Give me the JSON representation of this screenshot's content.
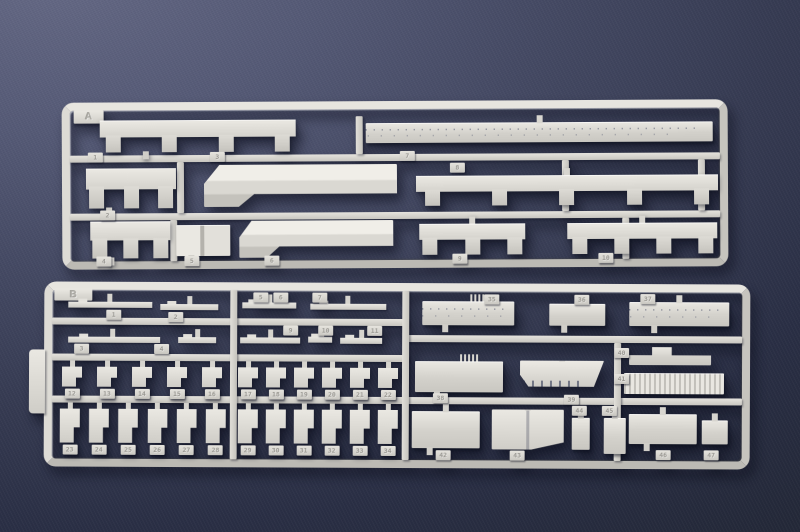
{
  "scene": {
    "subject": "Two injection-molded light-gray plastic model kit sprues (runners A and B) holding warship hull, deck and superstructure parts, photographed on a dark navy blue textured backdrop",
    "plastic_color": "#d8d6d0",
    "background_top_left": "#606482",
    "background_center": "#3d4259",
    "background_corner": "#252a3e"
  },
  "sprue_a": {
    "label": "A",
    "tags": {
      "p1": "1",
      "p2": "2",
      "p3": "3",
      "p4": "4",
      "p5": "5",
      "p6": "6",
      "p7": "7",
      "p8": "8",
      "p9": "9",
      "p10": "10"
    }
  },
  "sprue_b": {
    "label": "B",
    "strip_tags": {
      "l1": "1",
      "l2": "2",
      "l3": "3",
      "l4": "4",
      "m1": "5",
      "m2": "6",
      "m3": "7",
      "m4": "9",
      "m5": "10",
      "m6": "11"
    },
    "row3_left": [
      "12",
      "13",
      "14",
      "15",
      "16"
    ],
    "row3_mid": [
      "17",
      "18",
      "19",
      "20",
      "21",
      "22"
    ],
    "row4_left": [
      "23",
      "24",
      "25",
      "26",
      "27",
      "28"
    ],
    "row4_mid": [
      "29",
      "30",
      "31",
      "32",
      "33",
      "34"
    ],
    "tags": {
      "p35": "35",
      "p36": "36",
      "p37": "37",
      "p38": "38",
      "p39": "39",
      "p40": "40",
      "p41": "41",
      "p42": "42",
      "p43": "43",
      "p44": "44",
      "p45": "45",
      "p46": "46",
      "p47": "47"
    }
  }
}
